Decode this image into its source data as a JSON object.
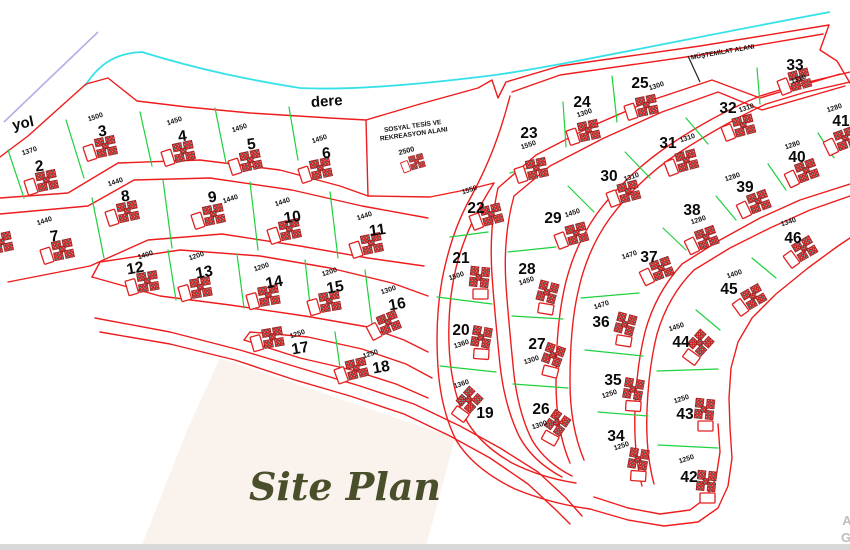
{
  "labels": {
    "road": "yol",
    "creek": "dere",
    "site_plan": "Site Plan",
    "outbuilding_area": "MÜŞTEMİLAT ALANI",
    "facility_line1": "SOSYAL TESİS VE",
    "facility_line2": "REKREASYON ALANI",
    "facility_area": "2500"
  },
  "watermark": {
    "line1": "A",
    "line2": "G"
  },
  "colors": {
    "parcel_line": "#ee1c1c",
    "divider_line": "#1ed13d",
    "creek_line": "#35e1e8",
    "road_line": "#b6aee8",
    "script_text": "#4a4f2b",
    "cream_area": "#f8efe7"
  },
  "lots": [
    {
      "no": "2",
      "area": "1370",
      "x": 40,
      "y": 166,
      "ax": 30,
      "ay": 153,
      "bx": 47,
      "by": 181,
      "br": -12,
      "nr": -8
    },
    {
      "no": "3",
      "area": "1500",
      "x": 103,
      "y": 131,
      "ax": 96,
      "ay": 119,
      "bx": 106,
      "by": 147,
      "br": -12,
      "nr": -8
    },
    {
      "no": "4",
      "area": "1450",
      "x": 183,
      "y": 136,
      "ax": 175,
      "ay": 123,
      "bx": 184,
      "by": 152,
      "br": -12,
      "nr": -8
    },
    {
      "no": "5",
      "area": "1450",
      "x": 252,
      "y": 144,
      "ax": 240,
      "ay": 130,
      "bx": 251,
      "by": 161,
      "br": -12,
      "nr": -8
    },
    {
      "no": "6",
      "area": "1450",
      "x": 327,
      "y": 153,
      "ax": 320,
      "ay": 141,
      "bx": 321,
      "by": 169,
      "br": -12,
      "nr": -8
    },
    {
      "no": "7",
      "area": "1440",
      "x": 55,
      "y": 236,
      "ax": 45,
      "ay": 223,
      "bx": 63,
      "by": 250,
      "br": -12,
      "nr": -8
    },
    {
      "no": "8",
      "area": "1440",
      "x": 126,
      "y": 196,
      "ax": 116,
      "ay": 184,
      "bx": 128,
      "by": 212,
      "br": -12,
      "nr": -8
    },
    {
      "no": "9",
      "area": "1440",
      "x": 213,
      "y": 197,
      "ax": 231,
      "ay": 201,
      "bx": 214,
      "by": 215,
      "br": -12,
      "nr": -8
    },
    {
      "no": "10",
      "area": "1440",
      "x": 293,
      "y": 217,
      "ax": 283,
      "ay": 204,
      "bx": 290,
      "by": 230,
      "br": -12,
      "nr": -8
    },
    {
      "no": "11",
      "area": "1440",
      "x": 378,
      "y": 230,
      "ax": 365,
      "ay": 218,
      "bx": 372,
      "by": 244,
      "br": -12,
      "nr": -8
    },
    {
      "no": "12",
      "area": "1400",
      "x": 136,
      "y": 268,
      "ax": 146,
      "ay": 257,
      "bx": 148,
      "by": 282,
      "br": -10,
      "nr": -10
    },
    {
      "no": "13",
      "area": "1200",
      "x": 205,
      "y": 272,
      "ax": 197,
      "ay": 258,
      "bx": 201,
      "by": 288,
      "br": -10,
      "nr": -10
    },
    {
      "no": "14",
      "area": "1200",
      "x": 275,
      "y": 282,
      "ax": 262,
      "ay": 269,
      "bx": 269,
      "by": 296,
      "br": -10,
      "nr": -10
    },
    {
      "no": "15",
      "area": "1200",
      "x": 336,
      "y": 287,
      "ax": 330,
      "ay": 274,
      "bx": 330,
      "by": 302,
      "br": -10,
      "nr": -10
    },
    {
      "no": "16",
      "area": "1300",
      "x": 398,
      "y": 304,
      "ax": 389,
      "ay": 292,
      "bx": 389,
      "by": 323,
      "br": -22,
      "nr": -10
    },
    {
      "no": "17",
      "area": "1250",
      "x": 301,
      "y": 348,
      "ax": 298,
      "ay": 336,
      "bx": 273,
      "by": 338,
      "br": -10,
      "nr": -10
    },
    {
      "no": "18",
      "area": "1250",
      "x": 382,
      "y": 367,
      "ax": 371,
      "ay": 356,
      "bx": 357,
      "by": 369,
      "br": -14,
      "nr": -10
    },
    {
      "no": "19",
      "area": "1360",
      "x": 485,
      "y": 413,
      "ax": 462,
      "ay": 386,
      "bx": 470,
      "by": 400,
      "br": -48,
      "nr": 0
    },
    {
      "no": "20",
      "area": "1360",
      "x": 461,
      "y": 330,
      "ax": 462,
      "ay": 346,
      "bx": 482,
      "by": 337,
      "br": -80,
      "nr": 0
    },
    {
      "no": "21",
      "area": "1500",
      "x": 461,
      "y": 258,
      "ax": 457,
      "ay": 278,
      "bx": 480,
      "by": 277,
      "br": -84,
      "nr": 0
    },
    {
      "no": "22",
      "area": "1550",
      "x": 476,
      "y": 208,
      "ax": 470,
      "ay": 192,
      "bx": 492,
      "by": 215,
      "br": -15,
      "nr": 0
    },
    {
      "no": "23",
      "area": "1550",
      "x": 529,
      "y": 133,
      "ax": 529,
      "ay": 147,
      "bx": 537,
      "by": 169,
      "br": -12,
      "nr": 0
    },
    {
      "no": "24",
      "area": "1300",
      "x": 582,
      "y": 102,
      "ax": 585,
      "ay": 115,
      "bx": 589,
      "by": 131,
      "br": -12,
      "nr": 0
    },
    {
      "no": "25",
      "area": "1300",
      "x": 640,
      "y": 83,
      "ax": 657,
      "ay": 88,
      "bx": 647,
      "by": 106,
      "br": -12,
      "nr": 0
    },
    {
      "no": "26",
      "area": "1300",
      "x": 541,
      "y": 409,
      "ax": 540,
      "ay": 427,
      "bx": 558,
      "by": 423,
      "br": -55,
      "nr": 0
    },
    {
      "no": "27",
      "area": "1300",
      "x": 537,
      "y": 344,
      "ax": 532,
      "ay": 362,
      "bx": 554,
      "by": 355,
      "br": -70,
      "nr": 0
    },
    {
      "no": "28",
      "area": "1450",
      "x": 527,
      "y": 269,
      "ax": 527,
      "ay": 283,
      "bx": 548,
      "by": 292,
      "br": -75,
      "nr": 0
    },
    {
      "no": "29",
      "area": "1450",
      "x": 553,
      "y": 218,
      "ax": 573,
      "ay": 215,
      "bx": 577,
      "by": 234,
      "br": -15,
      "nr": 0
    },
    {
      "no": "30",
      "area": "1310",
      "x": 609,
      "y": 176,
      "ax": 632,
      "ay": 179,
      "bx": 629,
      "by": 192,
      "br": -15,
      "nr": 0
    },
    {
      "no": "31",
      "area": "1310",
      "x": 668,
      "y": 143,
      "ax": 688,
      "ay": 140,
      "bx": 687,
      "by": 161,
      "br": -15,
      "nr": 0
    },
    {
      "no": "32",
      "area": "1310",
      "x": 728,
      "y": 108,
      "ax": 747,
      "ay": 110,
      "bx": 744,
      "by": 126,
      "br": -15,
      "nr": 0
    },
    {
      "no": "33",
      "area": "1310",
      "x": 795,
      "y": 65,
      "ax": 799,
      "ay": 81,
      "bx": 800,
      "by": 80,
      "br": -15,
      "nr": 0
    },
    {
      "no": "34",
      "area": "1250",
      "x": 616,
      "y": 436,
      "ax": 622,
      "ay": 448,
      "bx": 639,
      "by": 459,
      "br": -80,
      "nr": 0
    },
    {
      "no": "35",
      "area": "1250",
      "x": 613,
      "y": 380,
      "ax": 610,
      "ay": 396,
      "bx": 634,
      "by": 389,
      "br": -80,
      "nr": 0
    },
    {
      "no": "36",
      "area": "1470",
      "x": 601,
      "y": 322,
      "ax": 602,
      "ay": 307,
      "bx": 626,
      "by": 324,
      "br": -75,
      "nr": 0
    },
    {
      "no": "37",
      "area": "1470",
      "x": 649,
      "y": 257,
      "ax": 630,
      "ay": 257,
      "bx": 662,
      "by": 269,
      "br": -20,
      "nr": 0
    },
    {
      "no": "38",
      "area": "1280",
      "x": 692,
      "y": 210,
      "ax": 699,
      "ay": 222,
      "bx": 707,
      "by": 238,
      "br": -20,
      "nr": 0
    },
    {
      "no": "39",
      "area": "1280",
      "x": 745,
      "y": 187,
      "ax": 733,
      "ay": 179,
      "bx": 759,
      "by": 202,
      "br": -20,
      "nr": 0
    },
    {
      "no": "40",
      "area": "1280",
      "x": 797,
      "y": 157,
      "ax": 793,
      "ay": 147,
      "bx": 807,
      "by": 171,
      "br": -20,
      "nr": 0
    },
    {
      "no": "41",
      "area": "1280",
      "x": 841,
      "y": 121,
      "ax": 835,
      "ay": 110,
      "bx": 846,
      "by": 139,
      "br": -20,
      "nr": 0
    },
    {
      "no": "42",
      "area": "1250",
      "x": 689,
      "y": 477,
      "ax": 687,
      "ay": 461,
      "bx": 707,
      "by": 481,
      "br": -84,
      "nr": 0
    },
    {
      "no": "43",
      "area": "1250",
      "x": 685,
      "y": 414,
      "ax": 682,
      "ay": 401,
      "bx": 705,
      "by": 409,
      "br": -84,
      "nr": 0
    },
    {
      "no": "44",
      "area": "1450",
      "x": 681,
      "y": 342,
      "ax": 677,
      "ay": 329,
      "bx": 701,
      "by": 343,
      "br": -48,
      "nr": 0
    },
    {
      "no": "45",
      "area": "1400",
      "x": 729,
      "y": 289,
      "ax": 735,
      "ay": 276,
      "bx": 754,
      "by": 297,
      "br": -30,
      "nr": 0
    },
    {
      "no": "46",
      "area": "1340",
      "x": 793,
      "y": 238,
      "ax": 789,
      "ay": 224,
      "bx": 805,
      "by": 249,
      "br": -30,
      "nr": 0
    }
  ],
  "extra_buildings": [
    {
      "bx": 2,
      "by": 243,
      "br": -12,
      "s": 1
    },
    {
      "bx": 417,
      "by": 162,
      "br": -15,
      "s": 0.72
    }
  ]
}
